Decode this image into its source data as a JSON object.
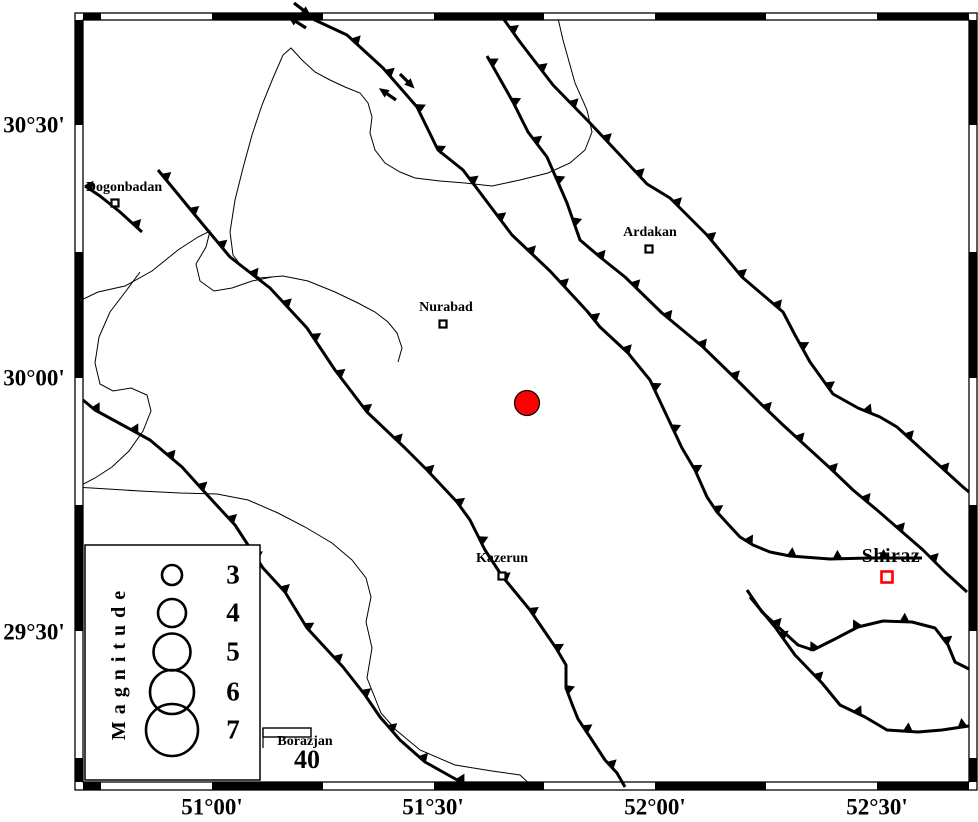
{
  "figure": {
    "width": 978,
    "height": 822,
    "background": "#ffffff"
  },
  "colors": {
    "line": "#000000",
    "epicenter_fill": "#ff0000",
    "major_city": "#ff0000",
    "frame_white": "#ffffff"
  },
  "axis": {
    "x_ticks": [
      {
        "label": "51°00'",
        "x": 212,
        "y": 807
      },
      {
        "label": "51°30'",
        "x": 433,
        "y": 807
      },
      {
        "label": "52°00'",
        "x": 655,
        "y": 807
      },
      {
        "label": "52°30'",
        "x": 877,
        "y": 807
      }
    ],
    "y_ticks": [
      {
        "label": "30°30'",
        "x": 34,
        "y": 125
      },
      {
        "label": "30°00'",
        "x": 34,
        "y": 378
      },
      {
        "label": "29°30'",
        "x": 34,
        "y": 632
      }
    ]
  },
  "frame": {
    "outer": {
      "x": 75,
      "y": 13,
      "w": 902,
      "h": 777
    },
    "inner": {
      "x": 83,
      "y": 20,
      "w": 886,
      "h": 762
    },
    "x_bounds": [
      83,
      101,
      212,
      323,
      434,
      544,
      655,
      766,
      877,
      969
    ],
    "y_bounds": [
      20,
      125,
      252,
      378,
      505,
      631,
      758,
      782
    ],
    "first_color": "#000000"
  },
  "cities": [
    {
      "name": "Dogonbadan",
      "label": "Dogonbadan",
      "label_pos": {
        "x": 124,
        "y": 188
      },
      "marker": {
        "x": 115,
        "y": 203,
        "size": 7,
        "color": "#000000"
      }
    },
    {
      "name": "Ardakan",
      "label": "Ardakan",
      "label_pos": {
        "x": 650,
        "y": 233
      },
      "marker": {
        "x": 649,
        "y": 249,
        "size": 7,
        "color": "#000000"
      }
    },
    {
      "name": "Nurabad",
      "label": "Nurabad",
      "label_pos": {
        "x": 446,
        "y": 308
      },
      "marker": {
        "x": 443,
        "y": 324,
        "size": 7,
        "color": "#000000"
      }
    },
    {
      "name": "Kazerun",
      "label": "Kazerun",
      "label_pos": {
        "x": 502,
        "y": 559
      },
      "marker": {
        "x": 502,
        "y": 576,
        "size": 7,
        "color": "#000000"
      }
    },
    {
      "name": "Shiraz",
      "label": "Shiraz",
      "label_pos": {
        "x": 891,
        "y": 556
      },
      "marker": {
        "x": 887,
        "y": 577,
        "size": 11,
        "color": "#ff0000"
      },
      "major": true
    },
    {
      "name": "Borazjan",
      "label": "Borazjan",
      "label_pos": {
        "x": 305,
        "y": 742
      },
      "marker": null
    }
  ],
  "epicenter": {
    "x": 527,
    "y": 403,
    "r": 12.5,
    "fill": "#ff0000"
  },
  "legend": {
    "box": {
      "x": 85,
      "y": 545,
      "w": 175,
      "h": 235
    },
    "title": "Magnitude",
    "title_pos": {
      "x": 119,
      "y": 662
    },
    "circle_x": 172,
    "entries": [
      {
        "label": "3",
        "r": 10,
        "cy": 575,
        "num_pos": {
          "x": 233,
          "y": 575
        }
      },
      {
        "label": "4",
        "r": 14,
        "cy": 613,
        "num_pos": {
          "x": 233,
          "y": 613
        }
      },
      {
        "label": "5",
        "r": 18.5,
        "cy": 652,
        "num_pos": {
          "x": 233,
          "y": 652
        }
      },
      {
        "label": "6",
        "r": 22,
        "cy": 692,
        "num_pos": {
          "x": 233,
          "y": 692
        }
      },
      {
        "label": "7",
        "r": 26,
        "cy": 730,
        "num_pos": {
          "x": 233,
          "y": 730
        }
      }
    ]
  },
  "scale_bar": {
    "rect": {
      "x": 263,
      "y": 728,
      "w": 48,
      "h": 9
    },
    "tick": {
      "x": 263,
      "y1": 728,
      "y2": 748
    },
    "label": "40",
    "label_pos": {
      "x": 307,
      "y": 760
    }
  },
  "faults": [
    {
      "name": "thrust-fault-main-recent",
      "points": [
        [
          302,
          14
        ],
        [
          347,
          35
        ],
        [
          383,
          68
        ],
        [
          417,
          107
        ],
        [
          438,
          150
        ],
        [
          463,
          170
        ],
        [
          512,
          235
        ],
        [
          550,
          271
        ],
        [
          587,
          311
        ],
        [
          600,
          327
        ],
        [
          628,
          353
        ],
        [
          650,
          380
        ],
        [
          665,
          412
        ],
        [
          682,
          448
        ],
        [
          695,
          470
        ],
        [
          707,
          497
        ],
        [
          717,
          512
        ],
        [
          727,
          523
        ],
        [
          740,
          537
        ],
        [
          753,
          545
        ],
        [
          770,
          552
        ],
        [
          790,
          556
        ],
        [
          830,
          559
        ],
        [
          870,
          558
        ],
        [
          922,
          558
        ]
      ],
      "teeth": {
        "spacing": 46,
        "offset": 14,
        "size": 9
      }
    },
    {
      "name": "thrust-fault-northeast",
      "points": [
        [
          500,
          14
        ],
        [
          520,
          42
        ],
        [
          553,
          85
        ],
        [
          590,
          123
        ],
        [
          620,
          155
        ],
        [
          647,
          184
        ],
        [
          670,
          198
        ],
        [
          707,
          235
        ],
        [
          742,
          277
        ],
        [
          783,
          312
        ],
        [
          795,
          335
        ],
        [
          810,
          362
        ],
        [
          833,
          394
        ],
        [
          858,
          408
        ],
        [
          880,
          417
        ],
        [
          897,
          427
        ],
        [
          930,
          457
        ],
        [
          963,
          487
        ],
        [
          969,
          492
        ]
      ],
      "teeth": {
        "spacing": 48,
        "offset": 20,
        "size": 9
      }
    },
    {
      "name": "thrust-fault-central",
      "points": [
        [
          487,
          56
        ],
        [
          513,
          102
        ],
        [
          528,
          132
        ],
        [
          547,
          157
        ],
        [
          567,
          203
        ],
        [
          580,
          240
        ],
        [
          600,
          257
        ],
        [
          625,
          277
        ],
        [
          662,
          313
        ],
        [
          703,
          347
        ],
        [
          740,
          383
        ],
        [
          760,
          403
        ],
        [
          783,
          425
        ],
        [
          807,
          447
        ],
        [
          830,
          468
        ],
        [
          853,
          490
        ],
        [
          877,
          510
        ],
        [
          900,
          530
        ],
        [
          923,
          550
        ],
        [
          945,
          572
        ],
        [
          967,
          592
        ]
      ],
      "teeth": {
        "spacing": 45,
        "offset": 8,
        "size": 9
      }
    },
    {
      "name": "kazerun-fault",
      "points": [
        [
          158,
          170
        ],
        [
          177,
          193
        ],
        [
          195,
          215
        ],
        [
          230,
          257
        ],
        [
          270,
          288
        ],
        [
          307,
          328
        ],
        [
          335,
          370
        ],
        [
          367,
          412
        ],
        [
          405,
          448
        ],
        [
          427,
          470
        ],
        [
          457,
          502
        ],
        [
          470,
          520
        ],
        [
          485,
          550
        ],
        [
          502,
          576
        ],
        [
          530,
          610
        ],
        [
          545,
          632
        ],
        [
          556,
          648
        ],
        [
          566,
          665
        ],
        [
          566,
          688
        ],
        [
          572,
          704
        ],
        [
          578,
          719
        ],
        [
          590,
          737
        ],
        [
          605,
          760
        ],
        [
          617,
          773
        ],
        [
          625,
          787
        ]
      ],
      "teeth": {
        "spacing": 44,
        "offset": 10,
        "size": 9
      }
    },
    {
      "name": "thrust-fault-southwest",
      "points": [
        [
          83,
          400
        ],
        [
          95,
          410
        ],
        [
          150,
          440
        ],
        [
          182,
          467
        ],
        [
          210,
          498
        ],
        [
          235,
          525
        ],
        [
          263,
          568
        ],
        [
          285,
          592
        ],
        [
          307,
          628
        ],
        [
          343,
          667
        ],
        [
          365,
          695
        ],
        [
          380,
          717
        ],
        [
          400,
          740
        ],
        [
          425,
          762
        ],
        [
          450,
          776
        ],
        [
          470,
          787
        ]
      ],
      "teeth": {
        "spacing": 44,
        "offset": 16,
        "size": 9
      }
    },
    {
      "name": "fault-dogonbadan",
      "points": [
        [
          85,
          186
        ],
        [
          100,
          196
        ],
        [
          120,
          212
        ],
        [
          142,
          232
        ]
      ],
      "teeth": {
        "spacing": 60,
        "offset": 4,
        "size": 9
      }
    },
    {
      "name": "thrust-fault-shiraz-north",
      "points": [
        [
          747,
          590
        ],
        [
          762,
          612
        ],
        [
          787,
          635
        ],
        [
          798,
          645
        ],
        [
          813,
          650
        ],
        [
          833,
          640
        ],
        [
          858,
          627
        ],
        [
          883,
          621
        ],
        [
          912,
          622
        ],
        [
          935,
          628
        ],
        [
          948,
          645
        ],
        [
          955,
          662
        ],
        [
          969,
          669
        ]
      ],
      "teeth": {
        "spacing": 48,
        "offset": 45,
        "size": 9
      }
    },
    {
      "name": "thrust-fault-shiraz-south",
      "points": [
        [
          750,
          597
        ],
        [
          775,
          627
        ],
        [
          795,
          655
        ],
        [
          822,
          683
        ],
        [
          840,
          705
        ],
        [
          865,
          717
        ],
        [
          887,
          730
        ],
        [
          918,
          732
        ],
        [
          942,
          730
        ],
        [
          962,
          727
        ],
        [
          969,
          726
        ]
      ],
      "teeth": {
        "spacing": 55,
        "offset": 50,
        "size": 9
      }
    }
  ],
  "rivers": [
    {
      "name": "river-lake-loop",
      "points": [
        [
          557,
          14
        ],
        [
          563,
          40
        ],
        [
          575,
          83
        ],
        [
          587,
          110
        ],
        [
          592,
          132
        ],
        [
          585,
          150
        ],
        [
          570,
          163
        ],
        [
          548,
          173
        ],
        [
          520,
          180
        ],
        [
          492,
          186
        ],
        [
          465,
          183
        ],
        [
          440,
          181
        ],
        [
          415,
          178
        ],
        [
          400,
          172
        ],
        [
          385,
          163
        ],
        [
          375,
          150
        ],
        [
          370,
          133
        ],
        [
          372,
          117
        ],
        [
          368,
          103
        ],
        [
          360,
          93
        ],
        [
          345,
          87
        ],
        [
          330,
          80
        ],
        [
          315,
          72
        ],
        [
          302,
          60
        ],
        [
          291,
          48
        ],
        [
          283,
          55
        ],
        [
          273,
          78
        ],
        [
          262,
          105
        ],
        [
          252,
          135
        ],
        [
          243,
          168
        ],
        [
          235,
          200
        ],
        [
          230,
          232
        ],
        [
          233,
          255
        ],
        [
          243,
          268
        ],
        [
          260,
          278
        ],
        [
          283,
          276
        ],
        [
          308,
          281
        ],
        [
          335,
          292
        ],
        [
          358,
          303
        ],
        [
          375,
          312
        ],
        [
          388,
          322
        ],
        [
          397,
          333
        ],
        [
          402,
          348
        ],
        [
          398,
          362
        ]
      ]
    },
    {
      "name": "river-west-upper",
      "points": [
        [
          75,
          303
        ],
        [
          98,
          292
        ],
        [
          125,
          286
        ],
        [
          152,
          271
        ],
        [
          178,
          250
        ],
        [
          198,
          237
        ],
        [
          210,
          231
        ],
        [
          206,
          247
        ],
        [
          196,
          264
        ],
        [
          200,
          281
        ],
        [
          214,
          291
        ],
        [
          232,
          288
        ],
        [
          252,
          281
        ],
        [
          272,
          277
        ]
      ]
    },
    {
      "name": "river-west-lower",
      "points": [
        [
          140,
          272
        ],
        [
          126,
          291
        ],
        [
          110,
          312
        ],
        [
          99,
          337
        ],
        [
          95,
          363
        ],
        [
          100,
          384
        ],
        [
          113,
          391
        ],
        [
          131,
          388
        ],
        [
          147,
          395
        ],
        [
          151,
          411
        ],
        [
          143,
          431
        ],
        [
          129,
          451
        ],
        [
          112,
          467
        ],
        [
          95,
          478
        ],
        [
          78,
          487
        ]
      ]
    },
    {
      "name": "river-south",
      "points": [
        [
          75,
          487
        ],
        [
          108,
          489
        ],
        [
          140,
          491
        ],
        [
          180,
          493
        ],
        [
          217,
          494
        ],
        [
          248,
          500
        ],
        [
          278,
          513
        ],
        [
          305,
          527
        ],
        [
          332,
          543
        ],
        [
          352,
          560
        ],
        [
          366,
          578
        ],
        [
          371,
          597
        ],
        [
          366,
          622
        ],
        [
          372,
          648
        ],
        [
          367,
          678
        ],
        [
          381,
          713
        ],
        [
          396,
          730
        ],
        [
          420,
          750
        ],
        [
          455,
          765
        ],
        [
          492,
          771
        ],
        [
          520,
          775
        ],
        [
          533,
          787
        ]
      ]
    }
  ],
  "strike_slip_arrows": [
    {
      "from": [
        294,
        3
      ],
      "to": [
        307,
        13
      ]
    },
    {
      "from": [
        306,
        28
      ],
      "to": [
        292,
        19
      ]
    },
    {
      "from": [
        400,
        74
      ],
      "to": [
        411,
        85
      ]
    },
    {
      "from": [
        396,
        100
      ],
      "to": [
        383,
        91
      ]
    }
  ]
}
